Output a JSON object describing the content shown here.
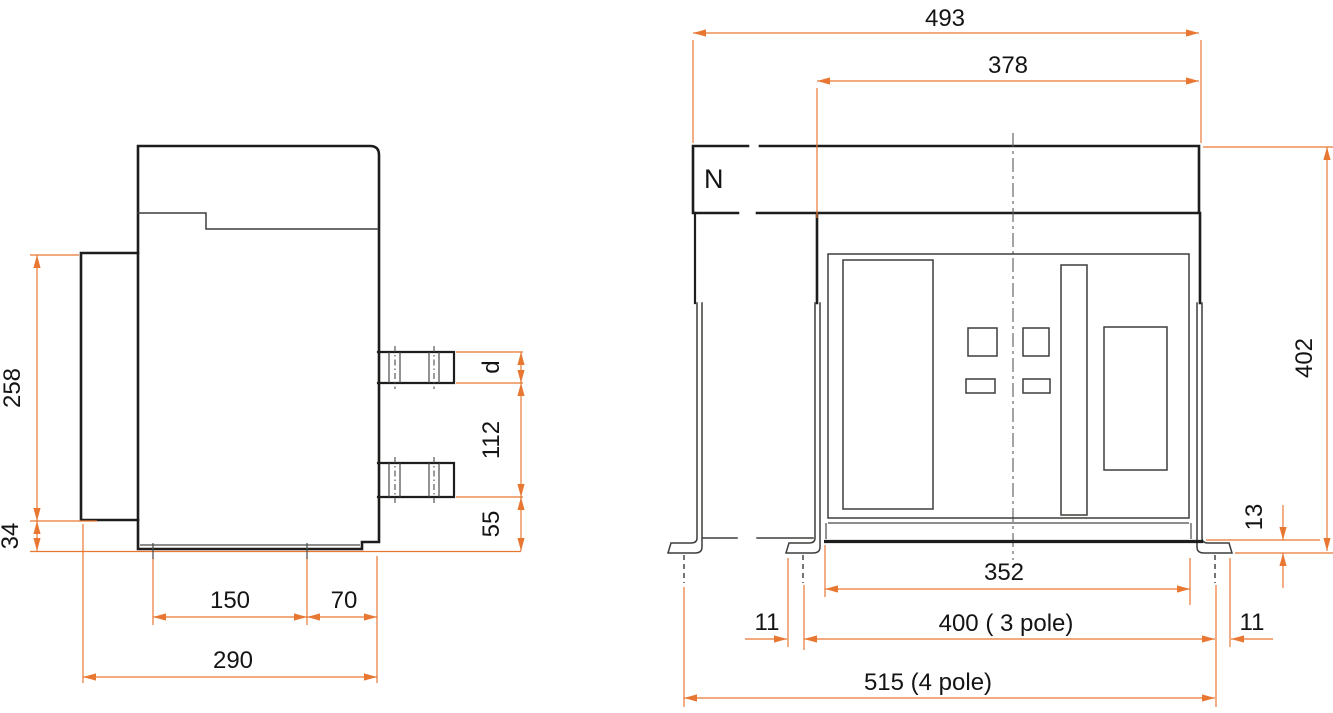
{
  "colors": {
    "dimension_line": "#e87732",
    "drawing_line": "#1d1d1b",
    "background": "#ffffff"
  },
  "side_view": {
    "dim_overall_height": "258",
    "dim_base_offset": "34",
    "dim_depth_front": "150",
    "dim_depth_rear": "70",
    "dim_depth_total": "290",
    "dim_terminal_thickness": "d",
    "dim_terminal_pitch": "112",
    "dim_terminal_base_height": "55"
  },
  "front_view": {
    "neutral_pole_label": "N",
    "dim_width_overall": "493",
    "dim_width_body": "378",
    "dim_height_overall": "402",
    "dim_foot_height": "13",
    "dim_front_panel_width": "352",
    "dim_fixing_3pole": "400 ( 3 pole)",
    "dim_fixing_offset_left": "11",
    "dim_fixing_offset_right": "11",
    "dim_fixing_4pole": "515 (4 pole)"
  }
}
